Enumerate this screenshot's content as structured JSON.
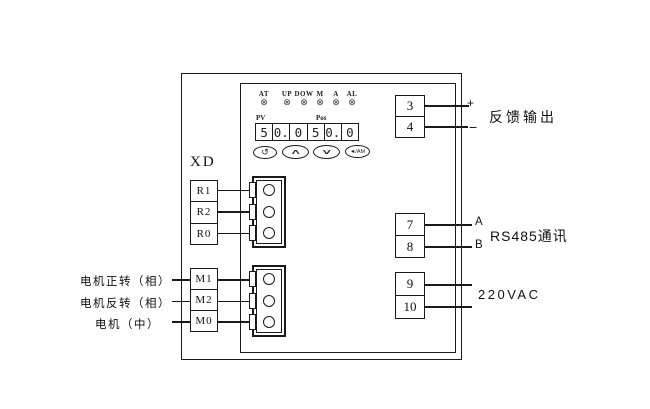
{
  "device": {
    "indicators": [
      "AT",
      "UP",
      "DOW",
      "M",
      "A",
      "AL"
    ],
    "led_symbol": "⊗",
    "display": {
      "pv_label": "PV",
      "pos_label": "Pos",
      "pv_value": "50.0",
      "pos_value": "50.0",
      "digits": [
        "5",
        "0.",
        "0",
        "5",
        "0.",
        "0"
      ]
    },
    "buttons": {
      "cycle": "↺",
      "up": "∧",
      "down": "∨",
      "auto_manual": "◄/AM"
    }
  },
  "terminals": {
    "xd_label": "XD",
    "r_group": [
      "R1",
      "R2",
      "R0"
    ],
    "m_group": [
      "M1",
      "M2",
      "M0"
    ],
    "m_wire_labels": [
      "电机正转（相）",
      "电机反转（相）",
      "电机（中）"
    ],
    "feedback": {
      "top": "3",
      "bottom": "4",
      "plus": "+",
      "minus": "−",
      "label": "反馈输出"
    },
    "rs485": {
      "top": "7",
      "bottom": "8",
      "line_a": "A",
      "line_b": "B",
      "label": "RS485通讯"
    },
    "power": {
      "top": "9",
      "bottom": "10",
      "label": "220VAC"
    }
  },
  "colors": {
    "line": "#1a1a1a",
    "background": "#ffffff"
  }
}
